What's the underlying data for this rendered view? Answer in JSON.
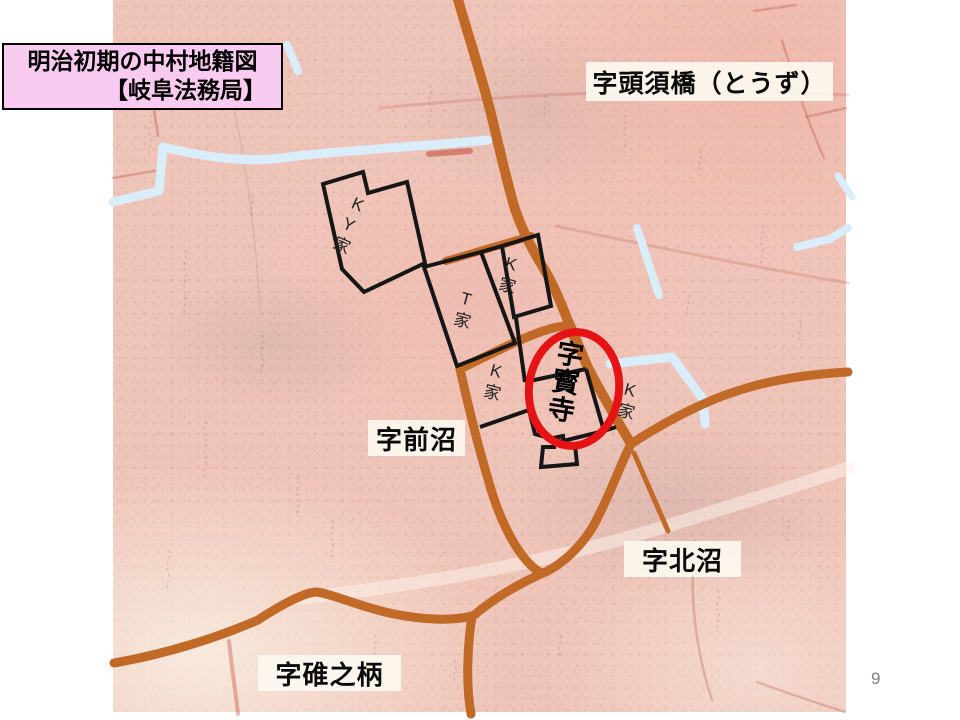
{
  "slide": {
    "page_number": "9"
  },
  "title_box": {
    "line1": "明治初期の中村地籍図",
    "line2": "【岐阜法務局】"
  },
  "area_labels": {
    "tozu": "字頭須橋（とうず）",
    "maenuma": "字前沼",
    "kitanuma": "字北沼",
    "usunoe": "字碓之柄"
  },
  "parcel_labels": {
    "ky": "KY家",
    "k_top": "K家",
    "t": "T家",
    "k_bottom": "K家",
    "k_right": "K家"
  },
  "highlight": {
    "label": "字寳寺"
  },
  "colors": {
    "road": "#c16a28",
    "waterway": "#d9eefa",
    "parcel_outline": "#161616",
    "highlight_circle": "#e51313",
    "map_base": "#f0c5b9",
    "title_box_bg": "#f9cbf0",
    "label_bg": "#fdf9f1"
  }
}
